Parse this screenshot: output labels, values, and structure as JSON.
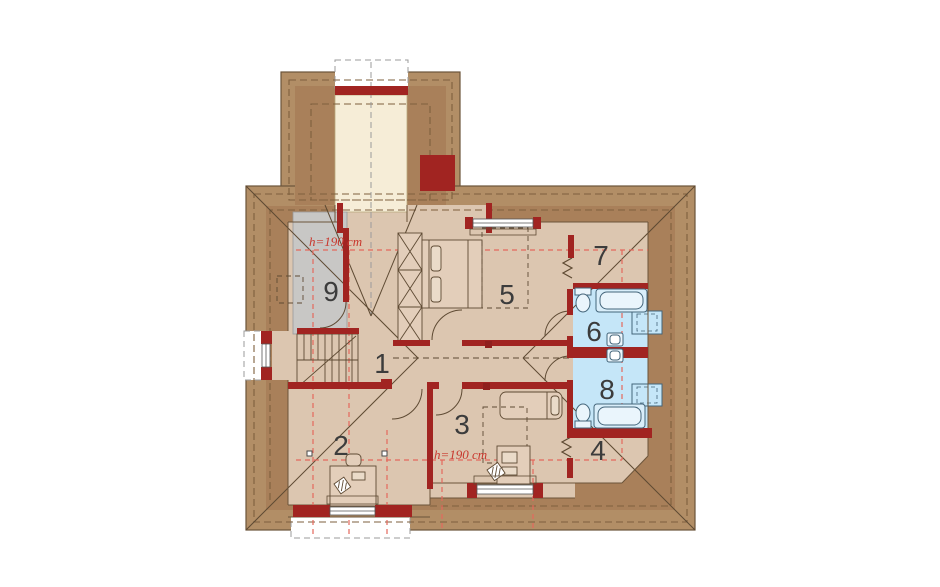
{
  "plan": {
    "rooms": [
      {
        "number": "1"
      },
      {
        "number": "2"
      },
      {
        "number": "3"
      },
      {
        "number": "4"
      },
      {
        "number": "5"
      },
      {
        "number": "6"
      },
      {
        "number": "7"
      },
      {
        "number": "8"
      },
      {
        "number": "9"
      }
    ],
    "annotations": [
      {
        "text": "h=190 cm"
      },
      {
        "text": "h=190 cm"
      }
    ],
    "colors": {
      "roof_outer": "#B28E66",
      "roof_inner": "#A9805A",
      "roof_dash": "#7E5F3D",
      "wall_red": "#A12421",
      "floor_tan": "#DCC6B0",
      "furniture_tan": "#E3CEBA",
      "bathroom_blue": "#C5E6F8",
      "storage_gray": "#C8C7C5",
      "void_cream": "#F6EDD7",
      "height_line_red": "#E4685C",
      "annotation_red": "#C8372D",
      "thin_line": "#5E4A33"
    }
  }
}
